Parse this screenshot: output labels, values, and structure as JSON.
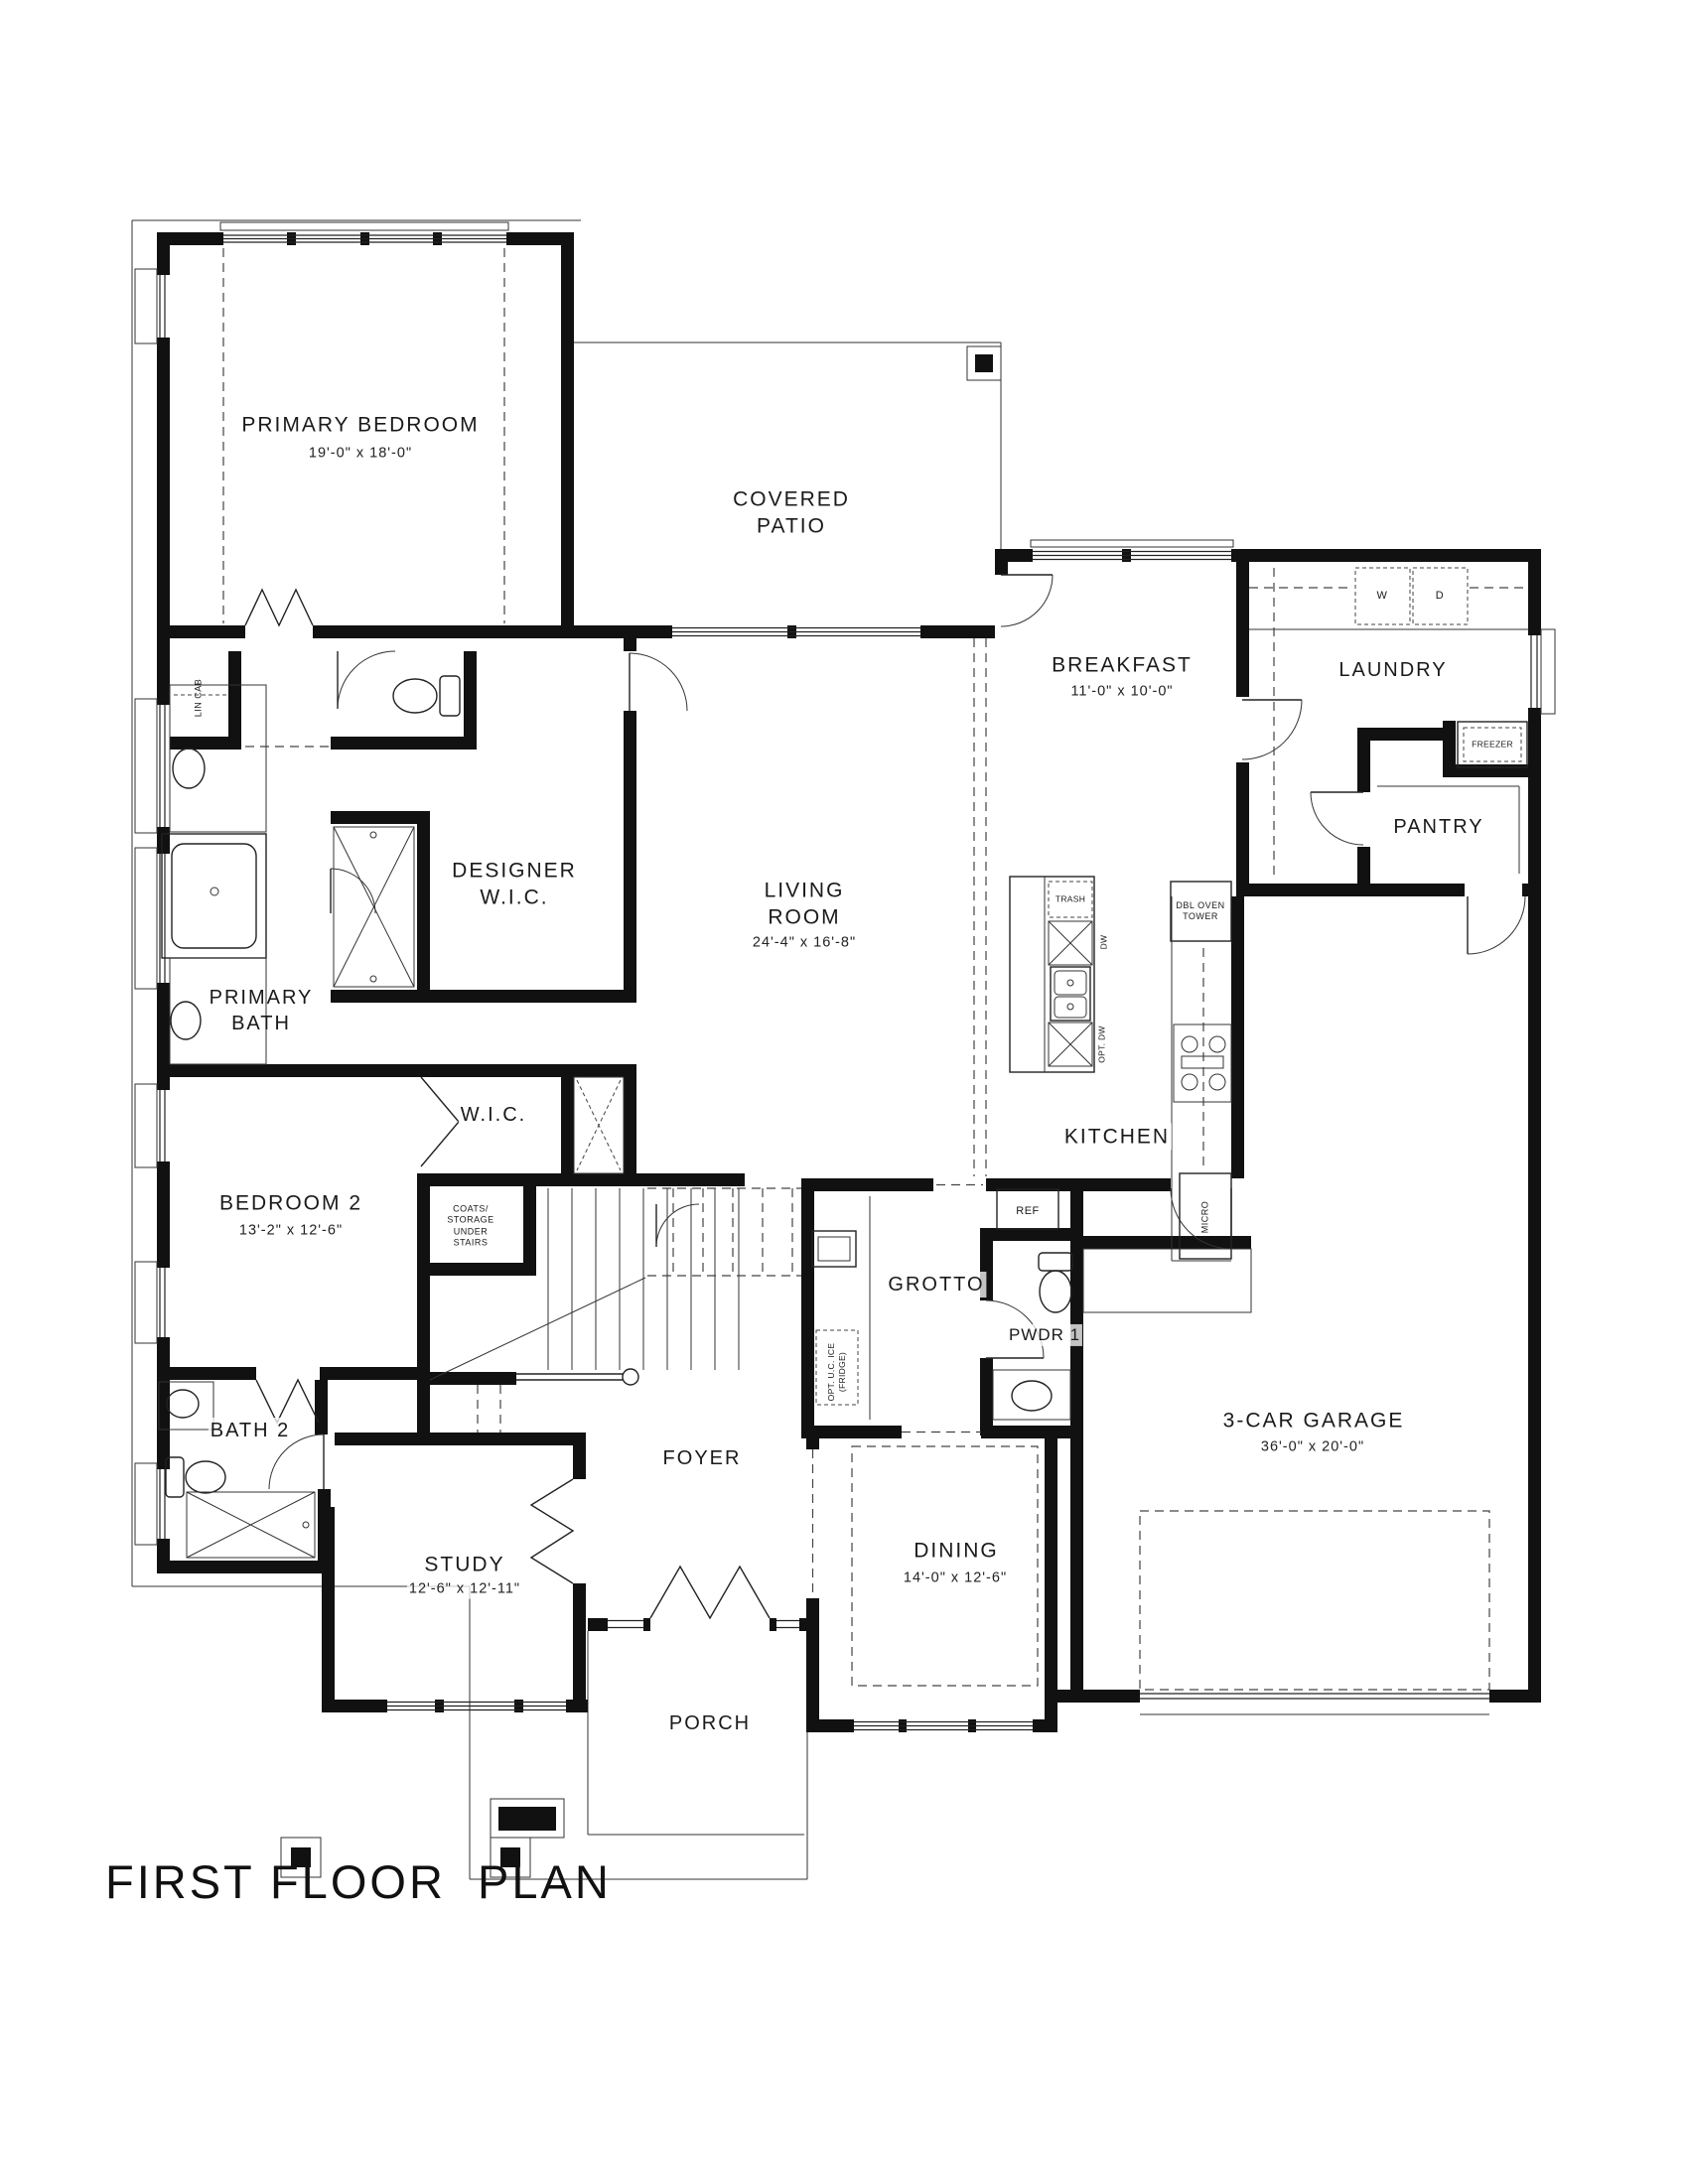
{
  "title": "FIRST FLOOR  PLAN",
  "rooms": {
    "primary_bedroom": {
      "name": "PRIMARY BEDROOM",
      "dims": "19'-0\" x 18'-0\""
    },
    "covered_patio": {
      "name": "COVERED PATIO"
    },
    "breakfast": {
      "name": "BREAKFAST",
      "dims": "11'-0\" x 10'-0\""
    },
    "laundry": {
      "name": "LAUNDRY"
    },
    "pantry": {
      "name": "PANTRY"
    },
    "designer_wic": {
      "name": "DESIGNER W.I.C."
    },
    "living_room": {
      "name": "LIVING ROOM",
      "dims": "24'-4\" x 16'-8\""
    },
    "primary_bath": {
      "name": "PRIMARY BATH"
    },
    "wic": {
      "name": "W.I.C."
    },
    "kitchen": {
      "name": "KITCHEN"
    },
    "bedroom_2": {
      "name": "BEDROOM 2",
      "dims": "13'-2\" x 12'-6\""
    },
    "grotto": {
      "name": "GROTTO"
    },
    "pwdr_1": {
      "name": "PWDR 1"
    },
    "bath_2": {
      "name": "BATH 2"
    },
    "garage": {
      "name": "3-CAR GARAGE",
      "dims": "36'-0\" x 20'-0\""
    },
    "foyer": {
      "name": "FOYER"
    },
    "study": {
      "name": "STUDY",
      "dims": "12'-6\" x 12'-11\""
    },
    "dining": {
      "name": "DINING",
      "dims": "14'-0\" x 12'-6\""
    },
    "porch": {
      "name": "PORCH"
    }
  },
  "fixtures": {
    "lin_cab": "LIN CAB",
    "washer": "W",
    "dryer": "D",
    "freezer": "FREEZER",
    "dbl_oven_tower": "DBL OVEN TOWER",
    "trash": "TRASH",
    "dw": "DW",
    "opt_dw": "OPT. DW",
    "micro": "MICRO",
    "ref": "REF",
    "coats": "COATS/ STORAGE UNDER STAIRS",
    "opt_ice": "OPT. U.C. ICE (FRIDGE)"
  }
}
